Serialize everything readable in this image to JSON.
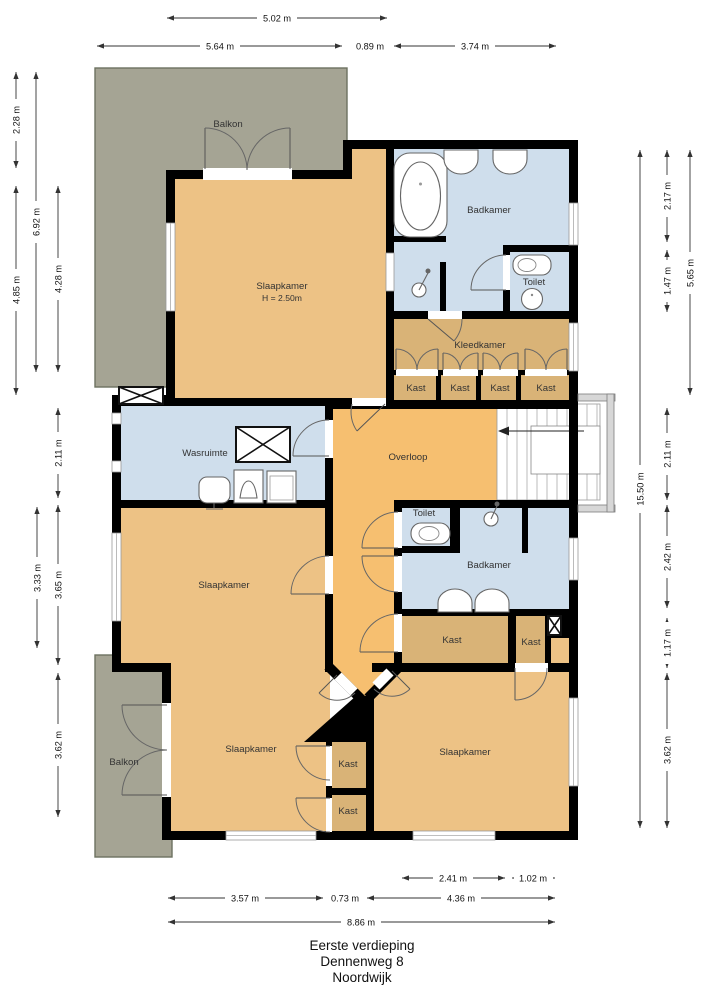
{
  "title": {
    "line1": "Eerste verdieping",
    "line2": "Dennenweg 8",
    "line3": "Noordwijk"
  },
  "colors": {
    "wall": "#000000",
    "bedroom": "#edc285",
    "overloop": "#f6bf70",
    "closet": "#d9b377",
    "wet": "#cfdeec",
    "balcony": "#a5a494",
    "balcony_border": "#6d7260"
  },
  "rooms": {
    "balkon_top": "Balkon",
    "slaapkamer_tl": "Slaapkamer",
    "slaapkamer_tl_h": "H = 2.50m",
    "badkamer_top": "Badkamer",
    "toilet_top": "Toilet",
    "kleedkamer": "Kleedkamer",
    "kast_row_1": "Kast",
    "kast_row_2": "Kast",
    "kast_row_3": "Kast",
    "kast_row_4": "Kast",
    "wasruimte": "Wasruimte",
    "overloop": "Overloop",
    "slaapkamer_mid": "Slaapkamer",
    "toilet_mid": "Toilet",
    "badkamer_mid": "Badkamer",
    "kast_mid_left": "Kast",
    "kast_mid_right": "Kast",
    "balkon_bottom": "Balkon",
    "slaapkamer_bottom_left": "Slaapkamer",
    "kast_col_1": "Kast",
    "kast_col_2": "Kast",
    "slaapkamer_bottom_right": "Slaapkamer"
  },
  "dims": {
    "t1": "5.02 m",
    "t2": "5.64 m",
    "t3": "0.89 m",
    "t4": "3.74 m",
    "l1": "2.28 m",
    "l2": "6.92 m",
    "l3": "4.85 m",
    "l4": "4.28 m",
    "l5": "2.11 m",
    "l6": "3.33 m",
    "l7": "3.65 m",
    "l8": "3.62 m",
    "r1": "15.50 m",
    "r2": "2.17 m",
    "r3": "5.65 m",
    "r4": "1.47 m",
    "r5": "2.11 m",
    "r6": "2.42 m",
    "r7": "1.17 m",
    "r8": "3.62 m",
    "b1": "2.41 m",
    "b2": "1.02 m",
    "b3": "3.57 m",
    "b4": "0.73 m",
    "b5": "4.36 m",
    "b6": "8.86 m"
  }
}
